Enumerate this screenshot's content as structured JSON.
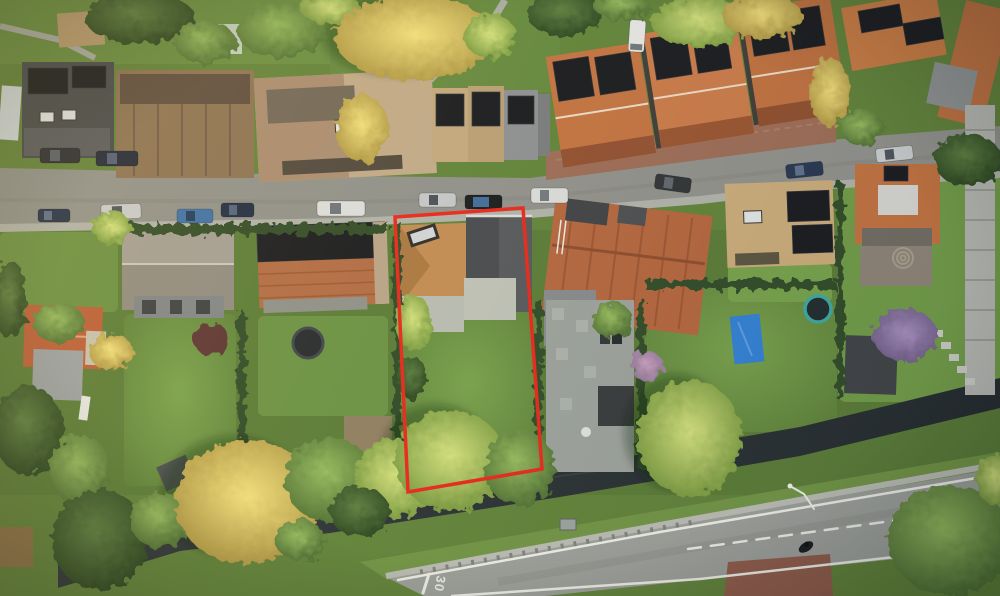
{
  "scene": {
    "type": "aerial-drone-photograph",
    "view": "top-down",
    "time_of_day": "golden hour, low warm evening sun",
    "description": "Top-down aerial photo of a Dutch residential street: a row of terraced houses with solar panels along a street with parked cars at the top, a second row of houses with deep rear gardens in the middle, a dark tree-lined canal and a through road with lane markings at the bottom. One property plot is outlined in red."
  },
  "overlay": {
    "label": "marked property boundary",
    "color": "#e62619",
    "boundary_points": "395,217 523,208 542,469 408,492",
    "stroke_width": "3.5"
  },
  "plot": {
    "features": [
      "tan hipped roof with roof window",
      "dark grey gabled rear wing",
      "light grey flat-roofed extension",
      "rear lawn",
      "mature trees on rear boundary"
    ]
  },
  "street": {
    "surface_color": "#8e8f8a",
    "parked_cars": [
      {
        "id": 1,
        "tone": "dark blue",
        "hex": "#233049"
      },
      {
        "id": 2,
        "tone": "silver",
        "hex": "#c6c9cc"
      },
      {
        "id": 3,
        "tone": "steel blue",
        "hex": "#3a6ea8"
      },
      {
        "id": 4,
        "tone": "dark navy",
        "hex": "#1d2a42"
      },
      {
        "id": 5,
        "tone": "white",
        "hex": "#dadcdc"
      },
      {
        "id": 6,
        "tone": "silver",
        "hex": "#c2c5c8"
      },
      {
        "id": 7,
        "tone": "black with glass roof",
        "hex": "#17191c"
      },
      {
        "id": 8,
        "tone": "white van",
        "hex": "#d8dad8"
      },
      {
        "id": 9,
        "tone": "dark grey",
        "hex": "#2e3134"
      },
      {
        "id": 10,
        "tone": "dark blue",
        "hex": "#25354f"
      },
      {
        "id": 11,
        "tone": "silver",
        "hex": "#c8cbcd"
      },
      {
        "id": 12,
        "tone": "dark grey",
        "hex": "#272b30"
      },
      {
        "id": 13,
        "tone": "dark navy",
        "hex": "#1f2638"
      },
      {
        "id": 14,
        "tone": "white van (vertical, by driveway)",
        "hex": "#e2e4e1"
      }
    ]
  },
  "road": {
    "marking_text": "30",
    "surface_color": "#9b9e99",
    "line_color": "#eceee6",
    "features": [
      "solid edge lines",
      "dashed centre line",
      "give-way tick",
      "brick-paved crossing",
      "street lamp",
      "motorcyclist"
    ]
  },
  "canal": {
    "water_color": "#2b3337"
  },
  "gardens": {
    "features": [
      "blue tarpaulin",
      "two trampolines",
      "garden sheds",
      "block-paved patio with bins",
      "hedged boundaries",
      "golden autumn trees",
      "small white boat"
    ]
  },
  "palette": {
    "grass": "#5f8138",
    "roof_terracotta": "#c0703d",
    "roof_dark_grey": "#4a4d50",
    "roof_tan": "#c3a87e",
    "solar_panel": "#16181d",
    "tarp_blue": "#2f7fd4",
    "trampoline_teal": "#3aa7a0",
    "boundary_red": "#e62619"
  }
}
